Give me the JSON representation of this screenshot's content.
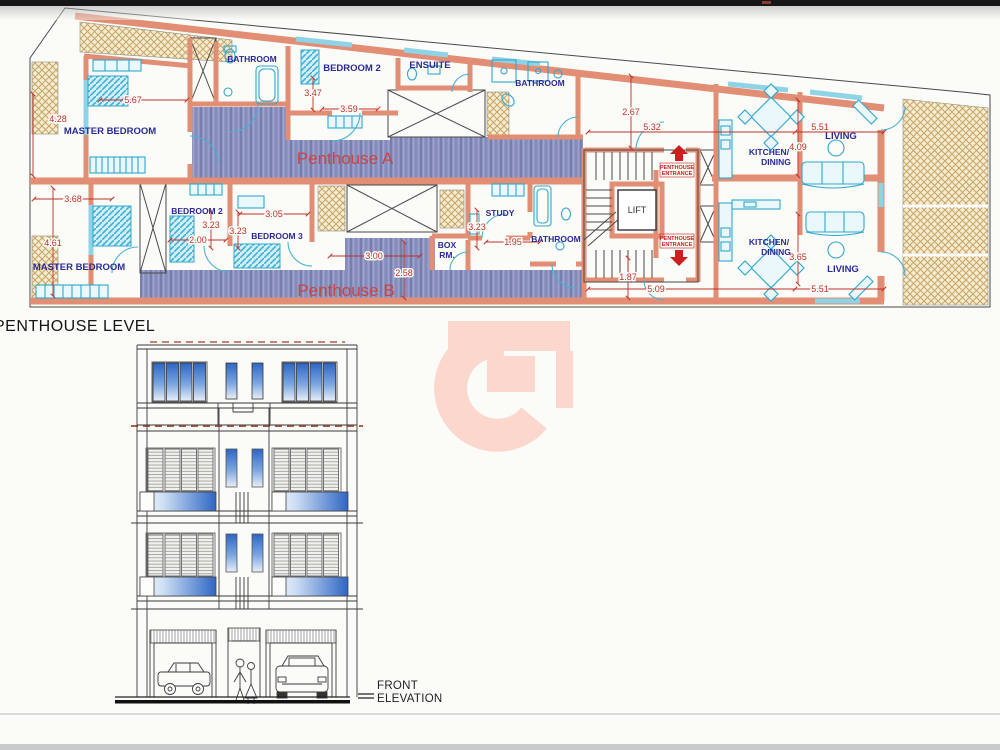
{
  "plan": {
    "level_label": "PENTHOUSE LEVEL",
    "unit_a_label": "Penthouse A",
    "unit_b_label": "Penthouse B",
    "lift_label": "LIFT",
    "entrance_line1": "PENTHOUSE",
    "entrance_line2": "ENTRANCE",
    "rooms_a": {
      "master": "MASTER BEDROOM",
      "bathroom_top": "BATHROOM",
      "bedroom2": "BEDROOM 2",
      "ensuite": "ENSUITE",
      "bathroom": "BATHROOM",
      "kitchen_line1": "KITCHEN/",
      "kitchen_line2": "DINING",
      "living": "LIVING"
    },
    "dims_a": {
      "master_w": "5.67",
      "master_d": "4.28",
      "bedroom2_d": "3.47",
      "bedroom2_w": "3.59",
      "hall": "2.67",
      "kitchen_w": "5.32",
      "living_w": "5.51",
      "living_d": "4.09"
    },
    "rooms_b": {
      "master": "MASTER BEDROOM",
      "bedroom2": "BEDROOM 2",
      "bedroom3": "BEDROOM 3",
      "study": "STUDY",
      "box_line1": "BOX",
      "box_line2": "RM.",
      "bathroom": "BATHROOM",
      "kitchen_line1": "KITCHEN/",
      "kitchen_line2": "DINING",
      "living": "LIVING"
    },
    "dims_b": {
      "master_w": "3.68",
      "master_d": "4.61",
      "bedroom2_d": "3.23",
      "bedroom2_w": "2.00",
      "bedroom3_w": "3.05",
      "bedroom3_d": "3.23",
      "hall_w": "3.00",
      "hall_d": "2.58",
      "study_d": "3.23",
      "study_w": "1.95",
      "entry": "1.87",
      "kitchen_w": "5.09",
      "living_w": "5.51",
      "living_d": "3.65"
    }
  },
  "elevation": {
    "label_line1": "FRONT",
    "label_line2": "ELEVATION"
  },
  "colors": {
    "wall": "#e28e75",
    "fixture": "#2fa8cc",
    "dimension": "#c03028",
    "room_text": "#2a2a96",
    "unit_text": "#cd4242",
    "floor": "#8e95c2",
    "hatch": "#c8a465",
    "watermark": "#fbd7ce",
    "glass": "#2e66c4"
  }
}
